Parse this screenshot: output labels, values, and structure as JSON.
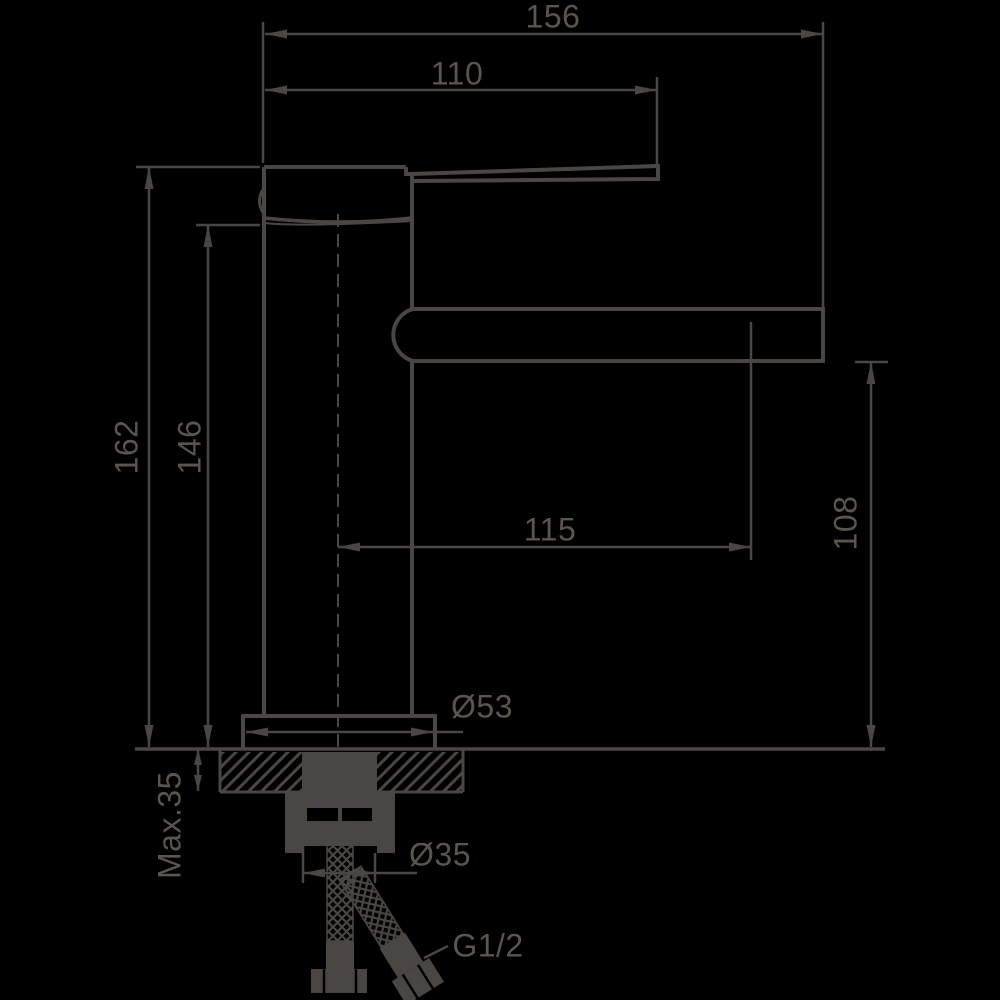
{
  "drawing": {
    "title": "faucet-installation-dimensions",
    "colors": {
      "background": "#000000",
      "stroke": "#4a4643",
      "text": "#5b5550"
    },
    "labels": {
      "d156": "156",
      "d110": "110",
      "d162": "162",
      "d146": "146",
      "d115": "115",
      "d108": "108",
      "d53": "Ø53",
      "dmax35": "Max.35",
      "d35": "Ø35",
      "g12": "G1/2"
    }
  }
}
